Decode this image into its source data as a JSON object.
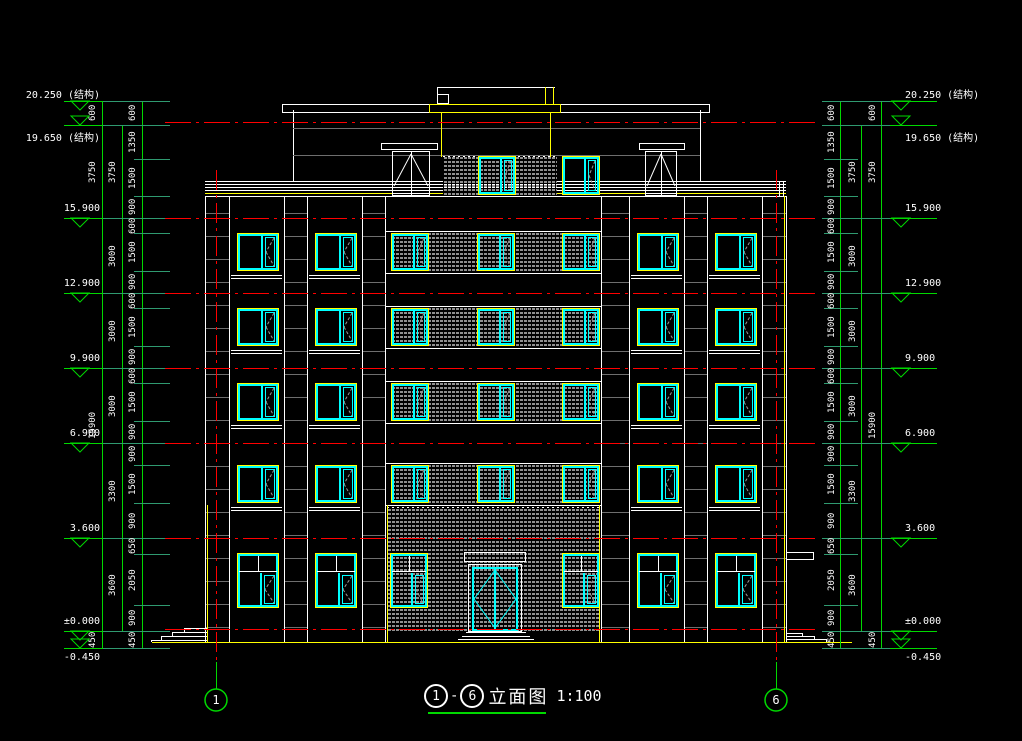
{
  "title": {
    "circled_from": "1",
    "circled_to": "6",
    "separator": "-",
    "text": "立面图",
    "scale": "1:100"
  },
  "grid_bubbles": [
    "1",
    "6"
  ],
  "levels": [
    {
      "value": "20.250",
      "suffix": "(结构)"
    },
    {
      "value": "19.650",
      "suffix": "(结构)"
    },
    {
      "value": "15.900",
      "suffix": ""
    },
    {
      "value": "12.900",
      "suffix": ""
    },
    {
      "value": "9.900",
      "suffix": ""
    },
    {
      "value": "6.900",
      "suffix": ""
    },
    {
      "value": "3.600",
      "suffix": ""
    },
    {
      "value": "±0.000",
      "suffix": ""
    },
    {
      "value": "-0.450",
      "suffix": ""
    }
  ],
  "dimensions": {
    "fine": [
      "600",
      "1350",
      "1500",
      "900",
      "600",
      "1500",
      "900",
      "600",
      "1500",
      "900",
      "600",
      "1500",
      "900",
      "900",
      "1500",
      "900",
      "650",
      "2050",
      "900",
      "450"
    ],
    "floor_heights": [
      "3750",
      "3000",
      "3000",
      "3000",
      "3300",
      "3600"
    ],
    "overall": [
      "600",
      "3750",
      "15900",
      "450"
    ]
  },
  "colors": {
    "background": "#000000",
    "dimension_green": "#00d900",
    "tick_green": "#2f9a70",
    "axis_red": "#ff0000",
    "outline_white": "#ffffff",
    "frame_cyan": "#00ffff",
    "highlight_yellow": "#ffff00",
    "band_gray": "#6e6e6e",
    "hatch_gray": "#8f8f8f"
  }
}
